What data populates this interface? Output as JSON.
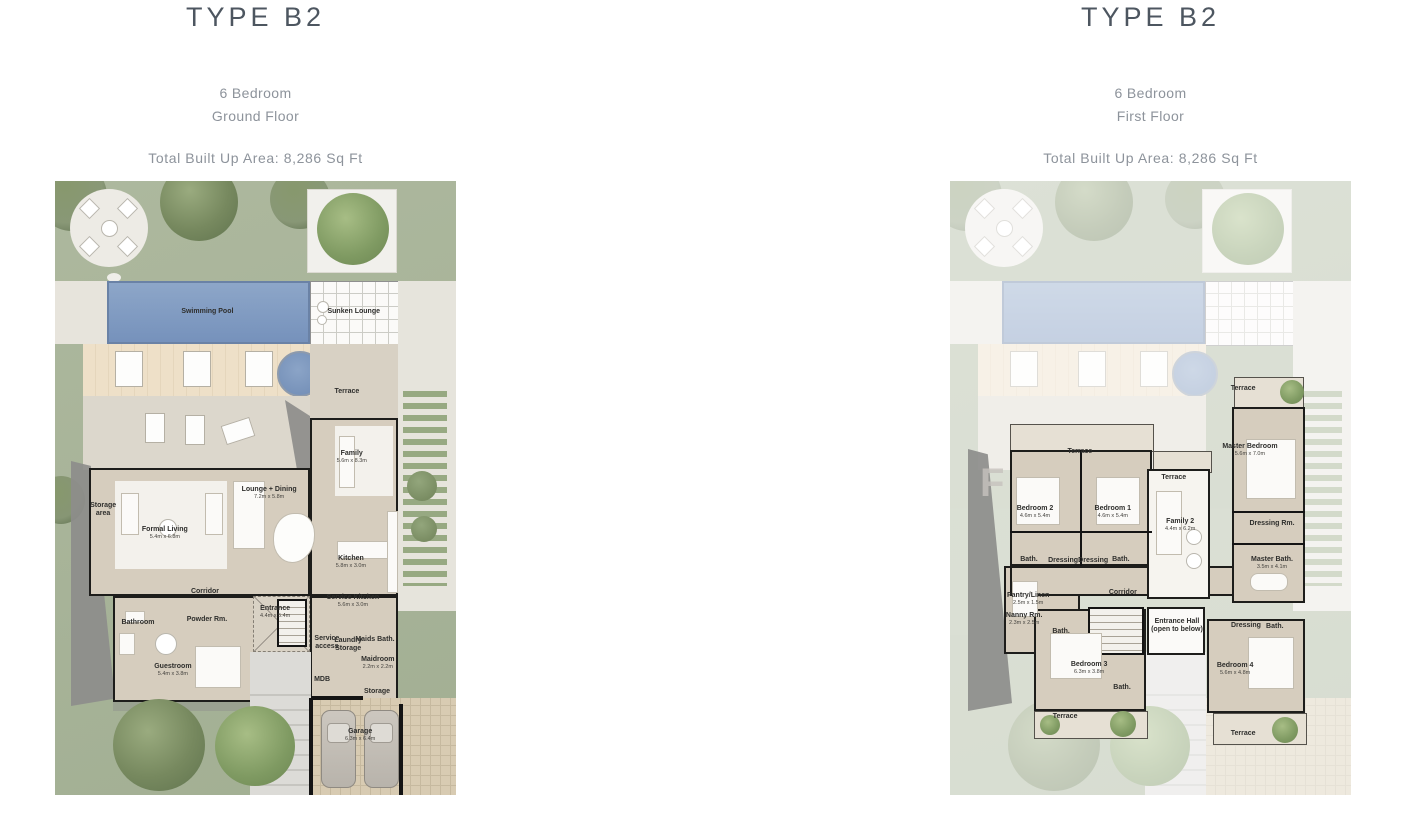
{
  "colors": {
    "title": "#4d5660",
    "subtitle": "#8d939b",
    "grass": "#a9b59b",
    "pool": "#8099c2",
    "deck": "#ecdcc4",
    "floor": "#d6cdbe",
    "wall": "#1d1d1b",
    "shadow": "#8d8d8b"
  },
  "panels": [
    {
      "title": "TYPE B2",
      "subtitle1": "6 Bedroom",
      "subtitle2": "Ground Floor",
      "area": "Total Built Up Area: 8,286 Sq Ft",
      "rooms": [
        {
          "name": "Swimming Pool",
          "x": 38,
          "y": 21.3
        },
        {
          "name": "Sunken Lounge",
          "x": 74.5,
          "y": 21.3
        },
        {
          "name": "Terrace",
          "x": 72.8,
          "y": 34.4
        },
        {
          "name": "Family",
          "sub": "5.6m x 8.3m",
          "x": 74,
          "y": 44.9
        },
        {
          "name": "Lounge + Dining",
          "sub": "7.2m x 5.8m",
          "x": 53.4,
          "y": 50.8
        },
        {
          "name": "Formal Living",
          "sub": "5.4m x 6.8m",
          "x": 27.4,
          "y": 57.3
        },
        {
          "name": "Storage",
          "name2": "area",
          "x": 12,
          "y": 53.6
        },
        {
          "name": "Kitchen",
          "sub": "5.8m x 3.0m",
          "x": 73.8,
          "y": 62
        },
        {
          "name": "Corridor",
          "x": 37.4,
          "y": 66.9
        },
        {
          "name": "Bathroom",
          "x": 20.7,
          "y": 72
        },
        {
          "name": "Powder Rm.",
          "x": 37.9,
          "y": 71.5
        },
        {
          "name": "Entrance",
          "sub": "4.4m x 5.4m",
          "x": 54.9,
          "y": 70.2
        },
        {
          "name": "Service Kitchen",
          "sub": "5.6m x 3.0m",
          "x": 74.3,
          "y": 68.4
        },
        {
          "name": "Service",
          "name2": "access",
          "x": 67.8,
          "y": 75.2
        },
        {
          "name": "Laundry",
          "name2": "Storage",
          "x": 73.1,
          "y": 75.6
        },
        {
          "name": "Maids Bath.",
          "x": 79.8,
          "y": 74.8
        },
        {
          "name": "Guestroom",
          "sub": "5.4m x 3.8m",
          "x": 29.4,
          "y": 79.6
        },
        {
          "name": "Maidroom",
          "sub": "2.2m x 2.2m",
          "x": 80.5,
          "y": 78.5
        },
        {
          "name": "MDB",
          "x": 66.6,
          "y": 81.3
        },
        {
          "name": "Storage",
          "x": 80.3,
          "y": 83.2
        },
        {
          "name": "Garage",
          "sub": "6.3m x 6.4m",
          "x": 76.1,
          "y": 90.2
        }
      ]
    },
    {
      "title": "TYPE B2",
      "subtitle1": "6 Bedroom",
      "subtitle2": "First Floor",
      "area": "Total Built Up Area: 8,286 Sq Ft",
      "rooms": [
        {
          "name": "Terrace",
          "x": 73.1,
          "y": 33.9
        },
        {
          "name": "Master Bedroom",
          "sub": "5.6m x 7.0m",
          "x": 74.8,
          "y": 43.8
        },
        {
          "name": "Terrace",
          "x": 32.4,
          "y": 44.1
        },
        {
          "name": "Bedroom 2",
          "sub": "4.6m x 5.4m",
          "x": 21.2,
          "y": 53.9
        },
        {
          "name": "Bedroom 1",
          "sub": "4.6m x 5.4m",
          "x": 40.6,
          "y": 53.9
        },
        {
          "name": "Terrace",
          "x": 55.8,
          "y": 48.4
        },
        {
          "name": "Family 2",
          "sub": "4.4m x 6.2m",
          "x": 57.4,
          "y": 56
        },
        {
          "name": "Dressing Rm.",
          "x": 80.3,
          "y": 55.9
        },
        {
          "name": "Bath.",
          "x": 19.7,
          "y": 61.7
        },
        {
          "name": "Dressing",
          "x": 28.2,
          "y": 61.9
        },
        {
          "name": "Dressing",
          "x": 35.7,
          "y": 61.9
        },
        {
          "name": "Bath.",
          "x": 42.6,
          "y": 61.7
        },
        {
          "name": "Master Bath.",
          "sub": "3.5m x 4.1m",
          "x": 80.3,
          "y": 62.2
        },
        {
          "name": "Pantry/Linen",
          "sub": "2.5m x 1.5m",
          "x": 19.5,
          "y": 68.1
        },
        {
          "name": "Nanny Rm.",
          "sub": "2.3m x 2.5m",
          "x": 18.5,
          "y": 71.3
        },
        {
          "name": "Bath.",
          "x": 27.7,
          "y": 73.5
        },
        {
          "name": "Corridor",
          "x": 43.1,
          "y": 67.1
        },
        {
          "name": "Entrance Hall",
          "name2": "(open to below)",
          "x": 56.6,
          "y": 72.5
        },
        {
          "name": "Dressing",
          "x": 73.8,
          "y": 72.5
        },
        {
          "name": "Bath.",
          "x": 81,
          "y": 72.6
        },
        {
          "name": "Bedroom 3",
          "sub": "6.3m x 3.8m",
          "x": 34.7,
          "y": 79.3
        },
        {
          "name": "Bath.",
          "x": 42.9,
          "y": 82.6
        },
        {
          "name": "Terrace",
          "x": 28.7,
          "y": 87.3
        },
        {
          "name": "Bedroom 4",
          "sub": "5.6m x 4.8m",
          "x": 71.1,
          "y": 79.5
        },
        {
          "name": "Terrace",
          "x": 73.1,
          "y": 90.1
        }
      ]
    }
  ]
}
